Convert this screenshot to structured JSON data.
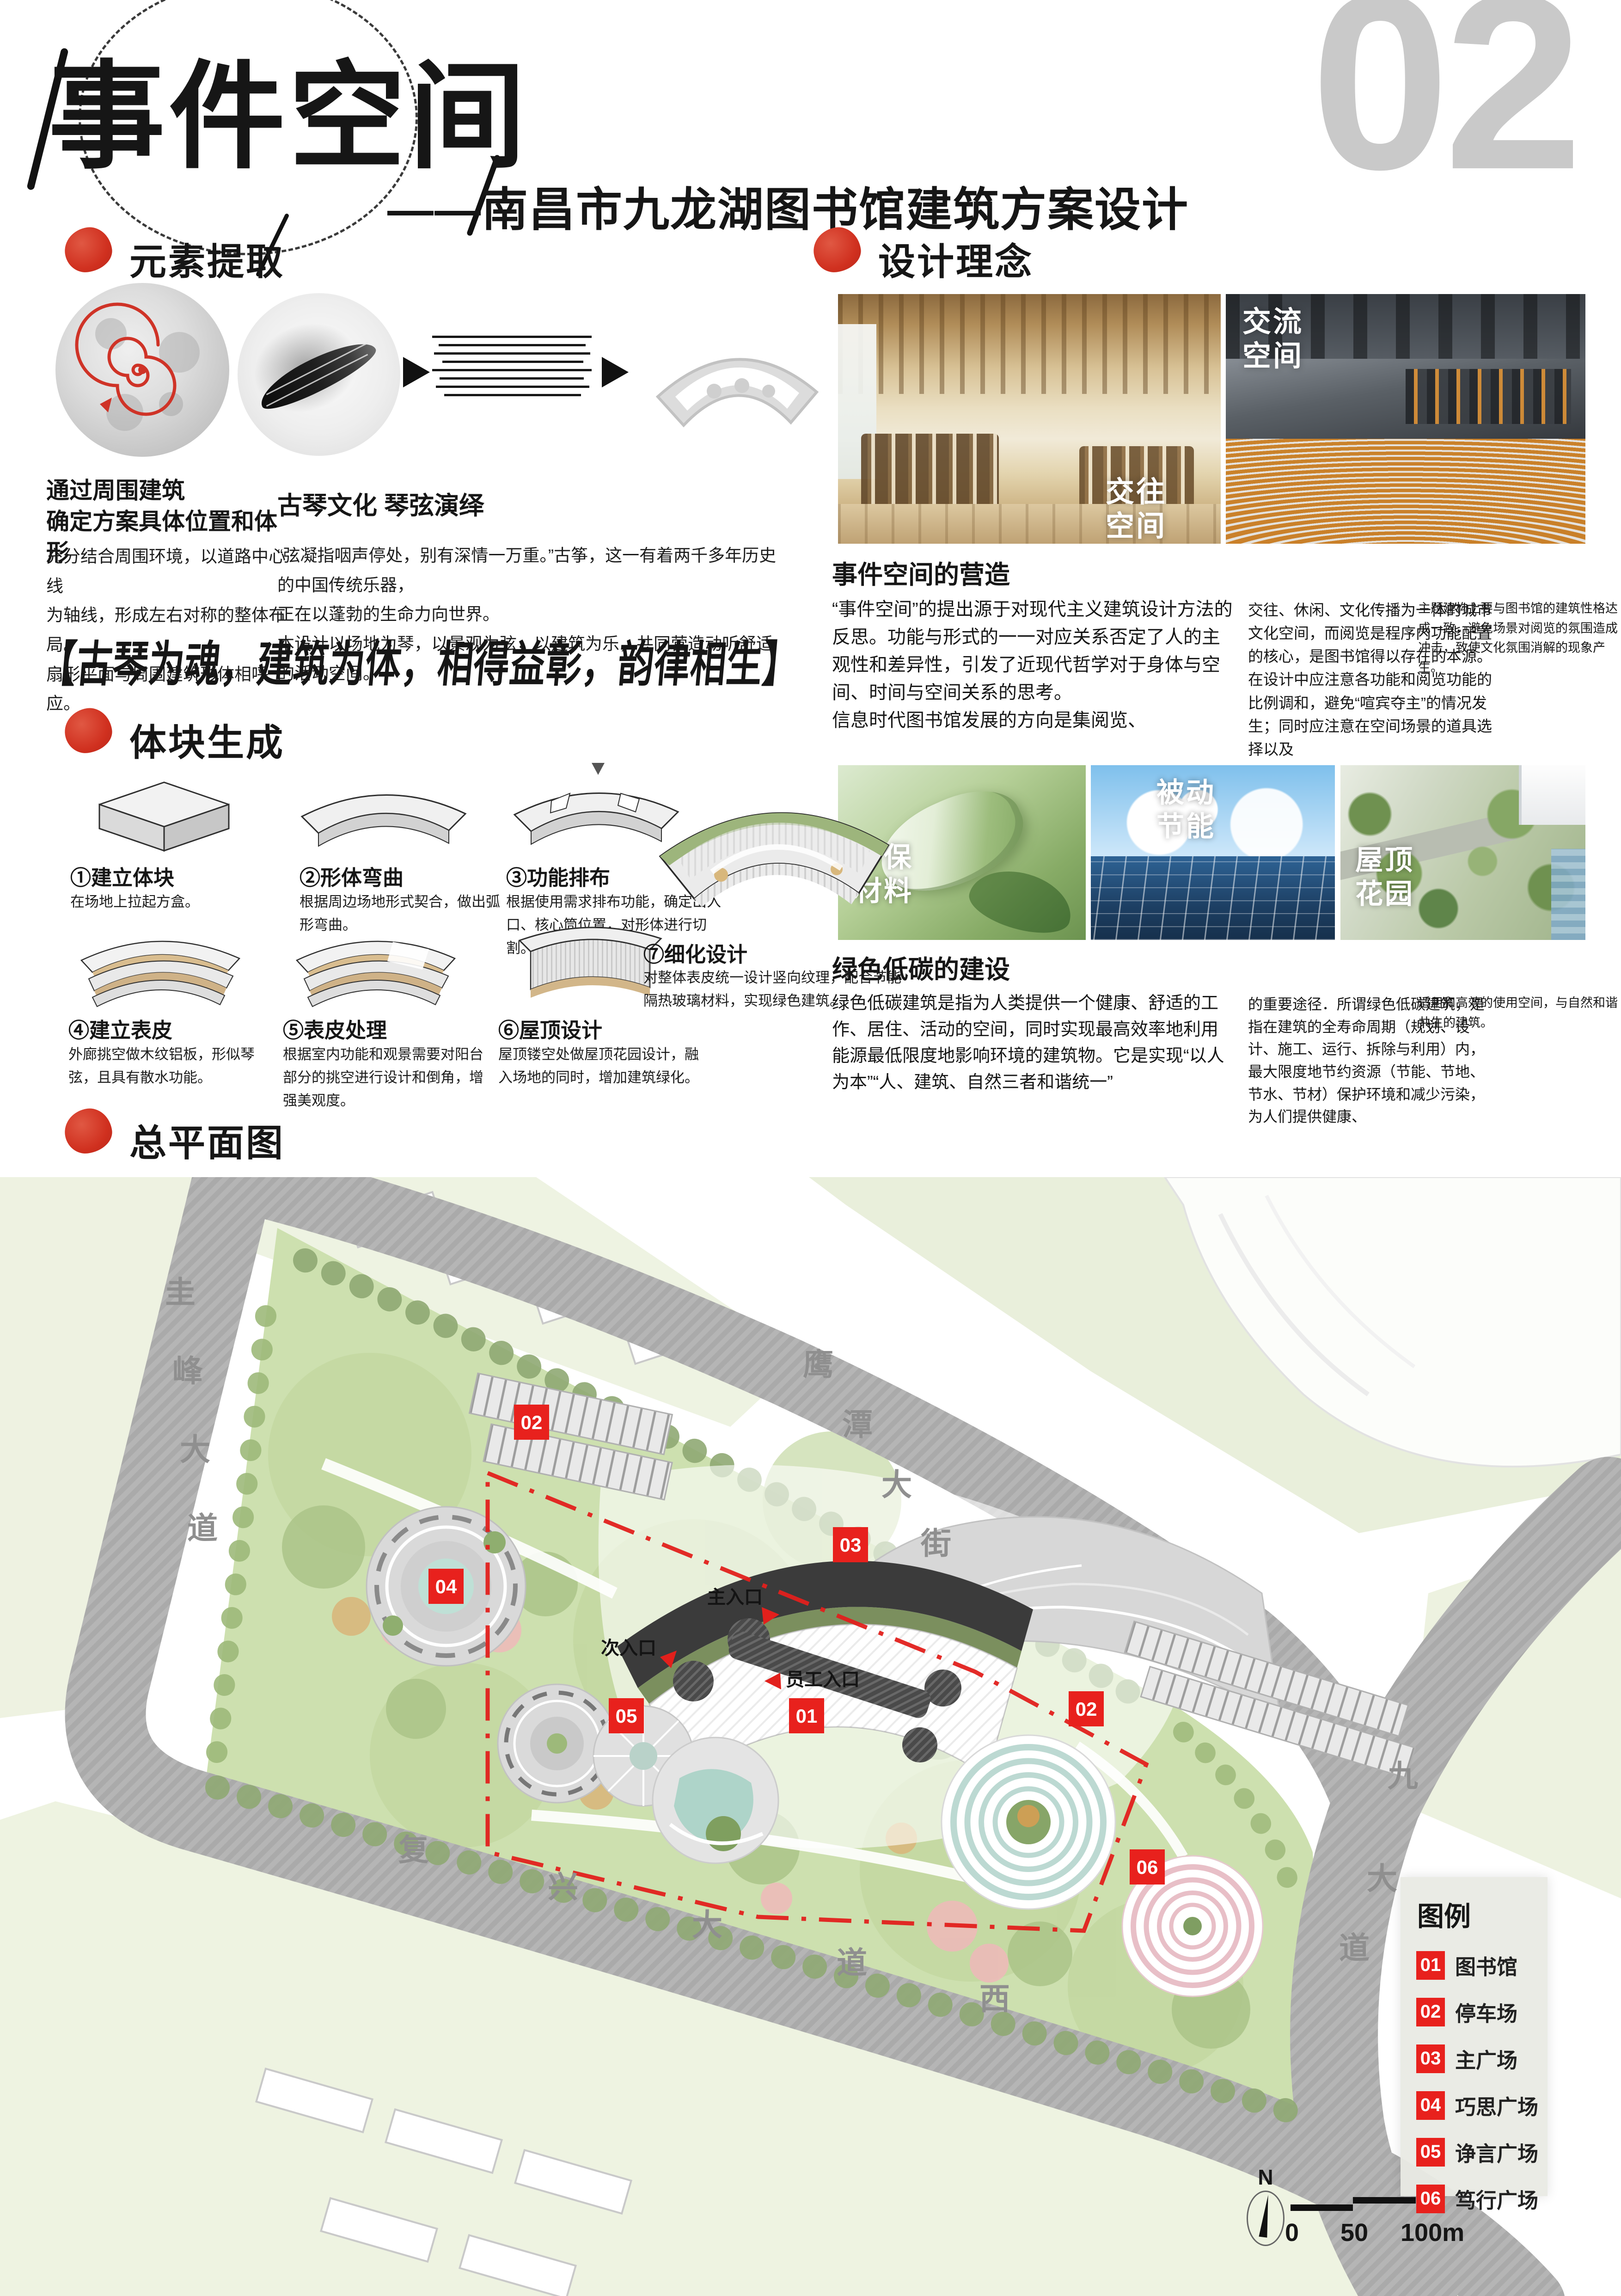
{
  "page_number": "02",
  "colors": {
    "accent_red": "#d0301f",
    "legend_red": "#e8211d",
    "page_number_gray": "#c9c9c9",
    "site_green": "#cde0af",
    "road_gray": "#b5b5b5"
  },
  "header": {
    "title": "事件空间",
    "subtitle": "——南昌市九龙湖图书馆建筑方案设计"
  },
  "section_extract": {
    "title": "元素提取",
    "caption1_title": "通过周围建筑\n确定方案具体位置和体形",
    "caption1_body": "充分结合周围环境，以道路中心线\n为轴线，形成左右对称的整体布局。\n扇形平面与周围建筑形体相呼应。",
    "caption2_title": "古琴文化 琴弦演绎",
    "caption2_body": "“弦凝指咽声停处，别有深情一万重。”古筝，这一有着两千多年历史的中国传统乐器，\n正在以蓬勃的生命力向世界。\n本设计以场地为琴，以景观为弦，以建筑为乐，共同营造动听舒适的活动空间。"
  },
  "quote": "【古琴为魂，建筑为体，相得益彰，韵律相生】",
  "section_concept": {
    "title": "设计理念",
    "photo1_label": "交往\n空间",
    "photo2_label": "交流\n空间",
    "sub1_title": "事件空间的营造",
    "sub1_col1": "“事件空间”的提出源于对现代主义建筑设计方法的反思。功能与形式的一一对应关系否定了人的主观性和差异性，引发了近现代哲学对于身体与空间、时间与空间关系的思考。\n信息时代图书馆发展的方向是集阅览、",
    "sub1_col2": "交往、休闲、文化传播为一体的城市文化空间，而阅览是程序内功能配置的核心，是图书馆得以存在的本源。\n在设计中应注意各功能和阅览功能的比例调和，避免“喧宾夺主”的情况发生；同时应注意在空间场景的道具选择以及",
    "sub1_col3": "主题建构上要与图书馆的建筑性格达成一致，避免场景对阅览的氛围造成冲击，致使文化氛围消解的现象产生。",
    "img1_label": "环保\n材料",
    "img2_label": "被动\n节能",
    "img3_label": "屋顶\n花园",
    "sub2_title": "绿色低碳的建设",
    "sub2_col1": "绿色低碳建筑是指为人类提供一个健康、舒适的工作、居住、活动的空间，同时实现最高效率地利用能源最低限度地影响环境的建筑物。它是实现“以人为本”“人、建筑、自然三者和谐统一”",
    "sub2_col2": "的重要途径．所谓绿色低碳建筑，是指在建筑的全寿命周期（规划、设计、施工、运行、拆除与利用）内，最大限度地节约资源（节能、节地、节水、节材）保护环境和减少污染，为人们提供健康、",
    "sub2_col3": "适用和高效的使用空间，与自然和谐共生的建筑。"
  },
  "section_massing": {
    "title": "体块生成",
    "steps": [
      {
        "label": "①建立体块",
        "desc": "在场地上拉起方盒。"
      },
      {
        "label": "②形体弯曲",
        "desc": "根据周边场地形式契合，做出弧形弯曲。"
      },
      {
        "label": "③功能排布",
        "desc": "根据使用需求排布功能，确定出入口、核心筒位置，对形体进行切割。"
      },
      {
        "label": "④建立表皮",
        "desc": "外廊挑空做木纹铝板，形似琴弦，且具有散水功能。"
      },
      {
        "label": "⑤表皮处理",
        "desc": "根据室内功能和观景需要对阳台部分的挑空进行设计和倒角，增强美观度。"
      },
      {
        "label": "⑥屋顶设计",
        "desc": "屋顶镂空处做屋顶花园设计，融入场地的同时，增加建筑绿化。"
      },
      {
        "label": "⑦细化设计",
        "desc": "对整体表皮统一设计竖向纹理，配合节能隔热玻璃材料，实现绿色建筑。"
      }
    ]
  },
  "section_plan": {
    "title": "总平面图",
    "roads": {
      "guifeng": [
        "圭",
        "峰",
        "大",
        "道"
      ],
      "yingtan": [
        "鹰",
        "潭",
        "大",
        "街"
      ],
      "fuxing": [
        "复",
        "兴",
        "大",
        "道",
        "西"
      ],
      "jiulong": [
        "九",
        "大",
        "道"
      ]
    },
    "entrances": {
      "main": "主入口",
      "secondary": "次入口",
      "staff": "员工入口"
    },
    "markers": [
      {
        "num": "01"
      },
      {
        "num": "02"
      },
      {
        "num": "03"
      },
      {
        "num": "04"
      },
      {
        "num": "05"
      },
      {
        "num": "02"
      },
      {
        "num": "06"
      }
    ],
    "legend": {
      "title": "图例",
      "items": [
        {
          "num": "01",
          "label": "图书馆"
        },
        {
          "num": "02",
          "label": "停车场"
        },
        {
          "num": "03",
          "label": "主广场"
        },
        {
          "num": "04",
          "label": "巧思广场"
        },
        {
          "num": "05",
          "label": "诤言广场"
        },
        {
          "num": "06",
          "label": "笃行广场"
        }
      ]
    },
    "north_label": "N",
    "scale": {
      "t0": "0",
      "t50": "50",
      "t100": "100m"
    }
  }
}
